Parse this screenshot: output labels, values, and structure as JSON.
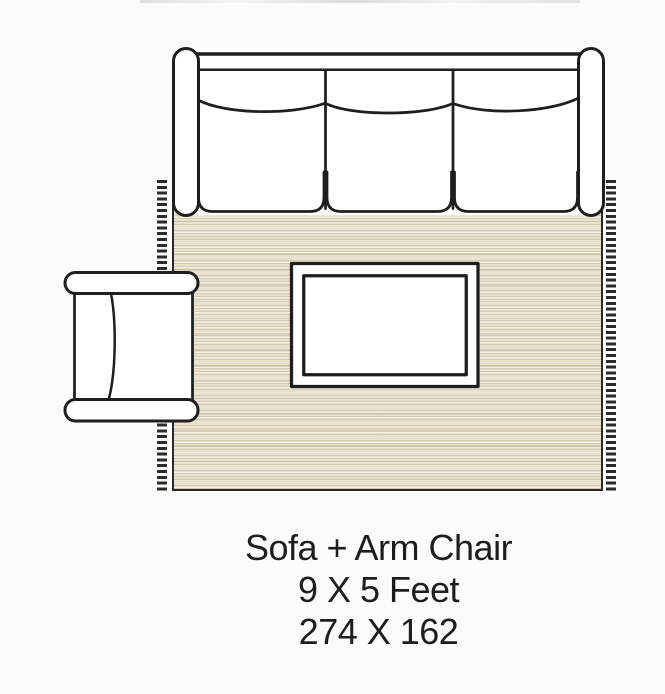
{
  "page": {
    "background_color": "#fbfbfb"
  },
  "diagram": {
    "name": "rug-size-layout",
    "colors": {
      "rug_fill": "#e8e1cc",
      "outline": "#1e1e1e",
      "furniture_fill": "#ffffff"
    },
    "items": [
      {
        "label": "rug with fringe"
      },
      {
        "label": "sofa"
      },
      {
        "label": "arm chair"
      },
      {
        "label": "coffee table"
      }
    ]
  },
  "caption": {
    "title": "Sofa + Arm Chair",
    "size_feet": "9 X 5 Feet",
    "size_numeric": "274 X 162"
  }
}
